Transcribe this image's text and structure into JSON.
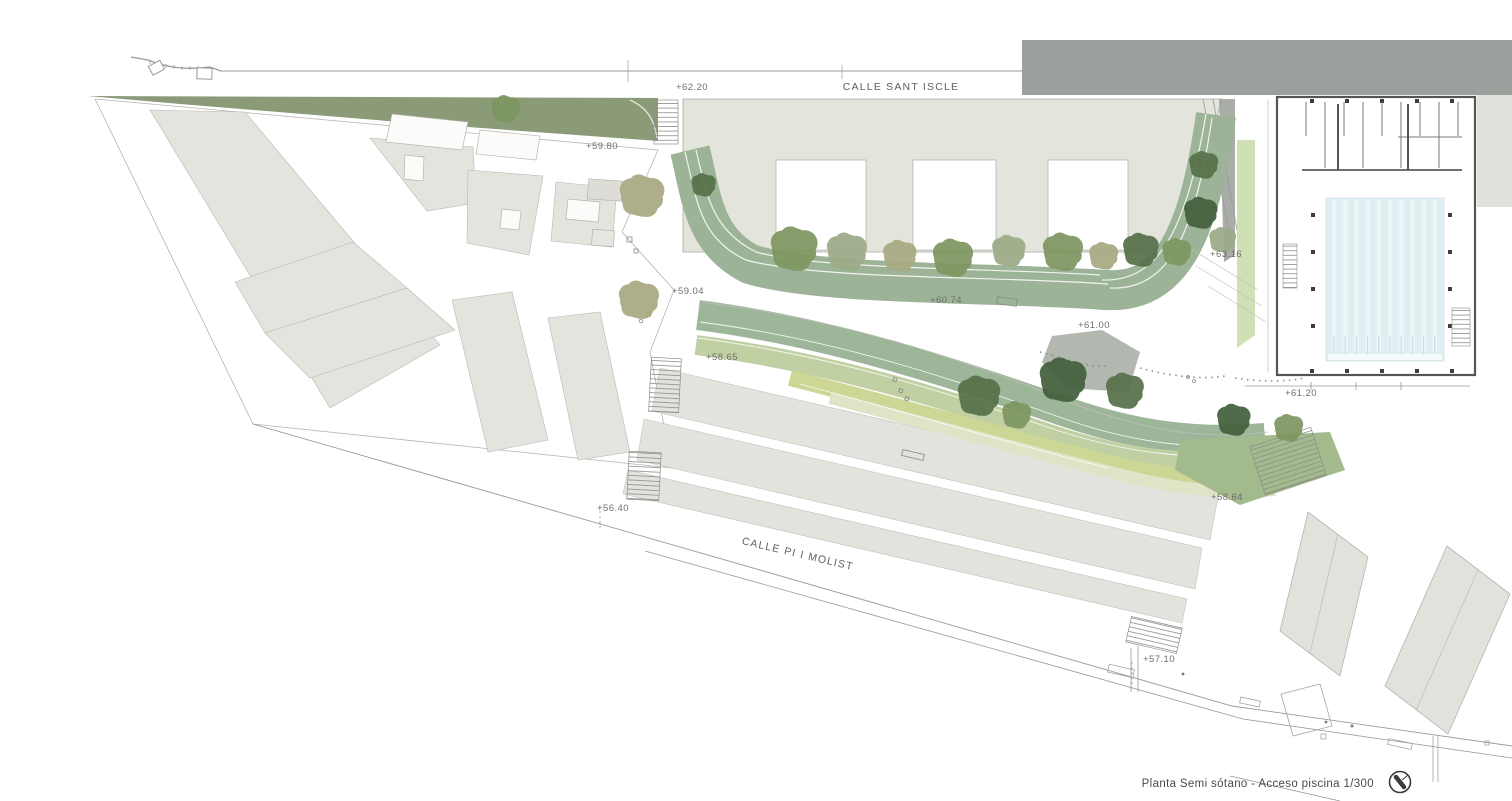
{
  "title_block": {
    "label": "Planta Semi sótano - Acceso piscina 1/300"
  },
  "streets": {
    "sant_iscle": {
      "label": "CALLE SANT ISCLE"
    },
    "pi_molist": {
      "label": "CALLE PI I MOLIST"
    }
  },
  "annotations": {
    "elevations": [
      {
        "label": "+62.20",
        "x": 676,
        "y": 90
      },
      {
        "label": "+59.80",
        "x": 586,
        "y": 149
      },
      {
        "label": "+59.04",
        "x": 672,
        "y": 294
      },
      {
        "label": "+58.65",
        "x": 706,
        "y": 360
      },
      {
        "label": "+56.40",
        "x": 597,
        "y": 511
      },
      {
        "label": "+60.74",
        "x": 930,
        "y": 303
      },
      {
        "label": "+61.00",
        "x": 1078,
        "y": 328
      },
      {
        "label": "+63.16",
        "x": 1210,
        "y": 257
      },
      {
        "label": "+61.20",
        "x": 1285,
        "y": 396
      },
      {
        "label": "+58.64",
        "x": 1211,
        "y": 500
      },
      {
        "label": "+57.10",
        "x": 1143,
        "y": 662
      }
    ]
  },
  "colors": {
    "paper": "#ffffff",
    "building_gray": "#e4e4df",
    "strip_gray": "#e2e3dd",
    "school_fill": "#e3e5dc",
    "dark_band": "#9aa09c",
    "sage_band": "#9cb398",
    "sweep_sage": "#9db69a",
    "green_mid": "#c0d0a2",
    "yellow_green": "#ccd795",
    "pale_green": "#dfe4c6",
    "olive_strip": "#8b9b78",
    "access_green": "#a3ba8c",
    "ramp_green": "#cfe0b5",
    "pool_water": "#dfeef0",
    "pool_lane": "#ecf6f7",
    "line": "#9a9a96",
    "text": "#6e6e6a",
    "tree": {
      "dark": "#57714a",
      "darker": "#43603c",
      "green": "#7e9660",
      "sage": "#9dab87",
      "olive": "#a8aa82"
    }
  },
  "plan": {
    "pool": {
      "lane_stripes": 10
    },
    "trees": [
      {
        "x": 505,
        "y": 109,
        "r": 13,
        "v": "green"
      },
      {
        "x": 641,
        "y": 196,
        "r": 20,
        "v": "olive"
      },
      {
        "x": 638,
        "y": 300,
        "r": 18,
        "v": "olive"
      },
      {
        "x": 703,
        "y": 185,
        "r": 11,
        "v": "dark"
      },
      {
        "x": 793,
        "y": 249,
        "r": 21,
        "v": "green"
      },
      {
        "x": 846,
        "y": 252,
        "r": 18,
        "v": "sage"
      },
      {
        "x": 899,
        "y": 256,
        "r": 15,
        "v": "olive"
      },
      {
        "x": 952,
        "y": 258,
        "r": 18,
        "v": "green"
      },
      {
        "x": 1008,
        "y": 251,
        "r": 15,
        "v": "sage"
      },
      {
        "x": 1062,
        "y": 252,
        "r": 18,
        "v": "green"
      },
      {
        "x": 1103,
        "y": 256,
        "r": 13,
        "v": "olive"
      },
      {
        "x": 1140,
        "y": 250,
        "r": 16,
        "v": "dark"
      },
      {
        "x": 1176,
        "y": 252,
        "r": 13,
        "v": "green"
      },
      {
        "x": 1203,
        "y": 165,
        "r": 13,
        "v": "dark"
      },
      {
        "x": 1200,
        "y": 213,
        "r": 15,
        "v": "darker"
      },
      {
        "x": 1222,
        "y": 240,
        "r": 12,
        "v": "sage"
      },
      {
        "x": 978,
        "y": 396,
        "r": 19,
        "v": "dark"
      },
      {
        "x": 1062,
        "y": 380,
        "r": 21,
        "v": "darker"
      },
      {
        "x": 1124,
        "y": 391,
        "r": 17,
        "v": "dark"
      },
      {
        "x": 1016,
        "y": 415,
        "r": 13,
        "v": "green"
      },
      {
        "x": 1233,
        "y": 420,
        "r": 15,
        "v": "darker"
      },
      {
        "x": 1288,
        "y": 428,
        "r": 13,
        "v": "green"
      }
    ]
  }
}
